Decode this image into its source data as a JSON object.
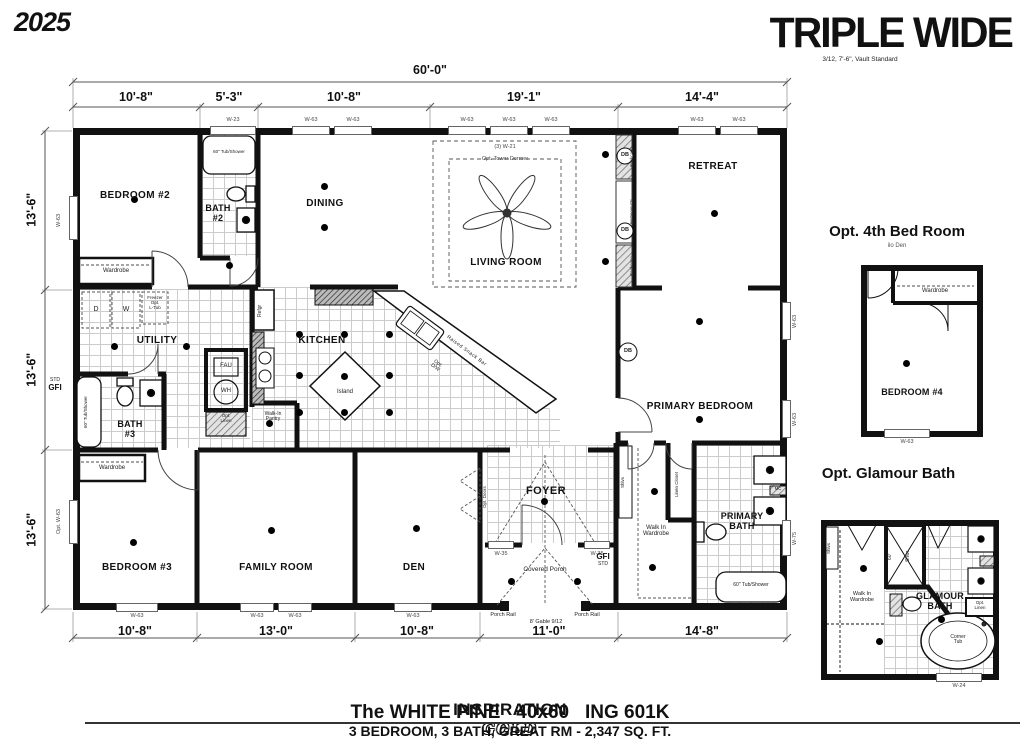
{
  "header": {
    "year": "2025",
    "title": "TRIPLE WIDE",
    "subtitle": "3/12, 7'-6\", Vault Standard"
  },
  "dims": {
    "overall": "60'-0\"",
    "top": [
      "10'-8\"",
      "5'-3\"",
      "10'-8\"",
      "19'-1\"",
      "14'-4\""
    ],
    "left": [
      "13'-6\"",
      "13'-6\"",
      "13'-6\""
    ],
    "bottom": [
      "10'-8\"",
      "13'-0\"",
      "10'-8\"",
      "11'-0\"",
      "14'-8\""
    ]
  },
  "windows": {
    "w23": "W-23",
    "w63": "W-63",
    "w21": "(3) W-21",
    "w35": "W-35",
    "w75": "W-75",
    "w24": "W-24",
    "opt_w63": "Opt. W-63"
  },
  "rooms": {
    "bedroom2": "BEDROOM #2",
    "bath2": "BATH\n#2",
    "dining": "DINING",
    "living": "LIVING ROOM",
    "retreat": "RETREAT",
    "utility": "UTILITY",
    "kitchen": "KITCHEN",
    "island": "Island",
    "primary_bedroom": "PRIMARY BEDROOM",
    "bath3": "BATH\n#3",
    "bedroom3": "BEDROOM #3",
    "family": "FAMILY ROOM",
    "den": "DEN",
    "foyer": "FOYER",
    "porch": "Covered Porch",
    "wardrobe_walkin": "Walk In\nWardrobe",
    "primary_bath": "PRIMARY\nBATH"
  },
  "fixtures": {
    "tub_shower": "60\" Tub/Shower",
    "wardrobe": "Wardrobe",
    "dryer": "D",
    "washer": "W",
    "freezer": "Freezer\nOpt.\nL-Tub",
    "fau": "FAU",
    "wh": "WH",
    "opt_linen": "Opt.\nLinen",
    "refgr": "Refgr",
    "snack_bar": "Raised Snack Bar",
    "opt_dw": "Opt.\nD/W",
    "pantry": "Walk-In\nPantry",
    "bookcase": "Bookcase",
    "ent_ctr": "Ent'ment Ctr",
    "db": "DB",
    "dormer": "Opt. Tower Dormer",
    "linen_closet": "Linen Closet",
    "shlvs": "Shlvs",
    "opt_doors": "Opt. Doors",
    "mc": "MC",
    "corner_tub": "Corner\nTub",
    "shwr_size": "60\"",
    "shwr": "Shwr",
    "porch_rail": "Porch Rail",
    "gable": "8' Gable 9/12",
    "gfi": "GFI",
    "std": "STD"
  },
  "insets": {
    "bed4": {
      "title": "Opt. 4th Bed Room",
      "subtitle": "ilo Den",
      "room": "BEDROOM #4"
    },
    "glamour": {
      "title": "Opt. Glamour Bath",
      "room": "GLAMOUR\nBATH"
    }
  },
  "footer": {
    "brand": "INSPIRATION",
    "series": "GOLD",
    "model": "The WHITE PINE   40x60   ING 601K",
    "specs": "3 BEDROOM, 3 BATH, GREAT RM - 2,347 SQ. FT."
  }
}
